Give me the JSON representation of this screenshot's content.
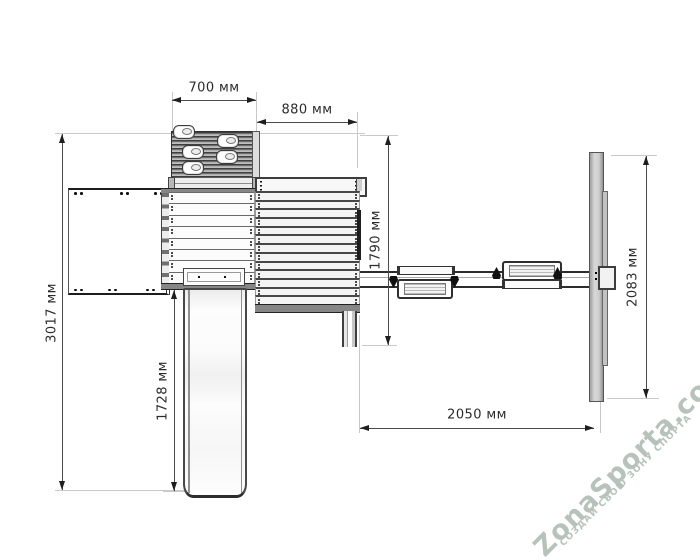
{
  "drawing": {
    "dimensions": {
      "climb_width": "700 мм",
      "upper_platform_width": "880 мм",
      "total_depth": "3017 мм",
      "slide_length": "1728 мм",
      "platform_depth": "1790 мм",
      "swing_frame_depth": "2083 мм",
      "swing_beam_length": "2050 мм"
    },
    "colors": {
      "line": "#3d3d3d",
      "reference_line": "#c9c9c9",
      "fill_gray": "#cccccc"
    }
  },
  "watermark": {
    "brand": "ZonaSporta.com",
    "slogan": "СОЗДАЙ СВОЮ ЗОНУ СПОРТА",
    "color": "#b6c2ba"
  }
}
